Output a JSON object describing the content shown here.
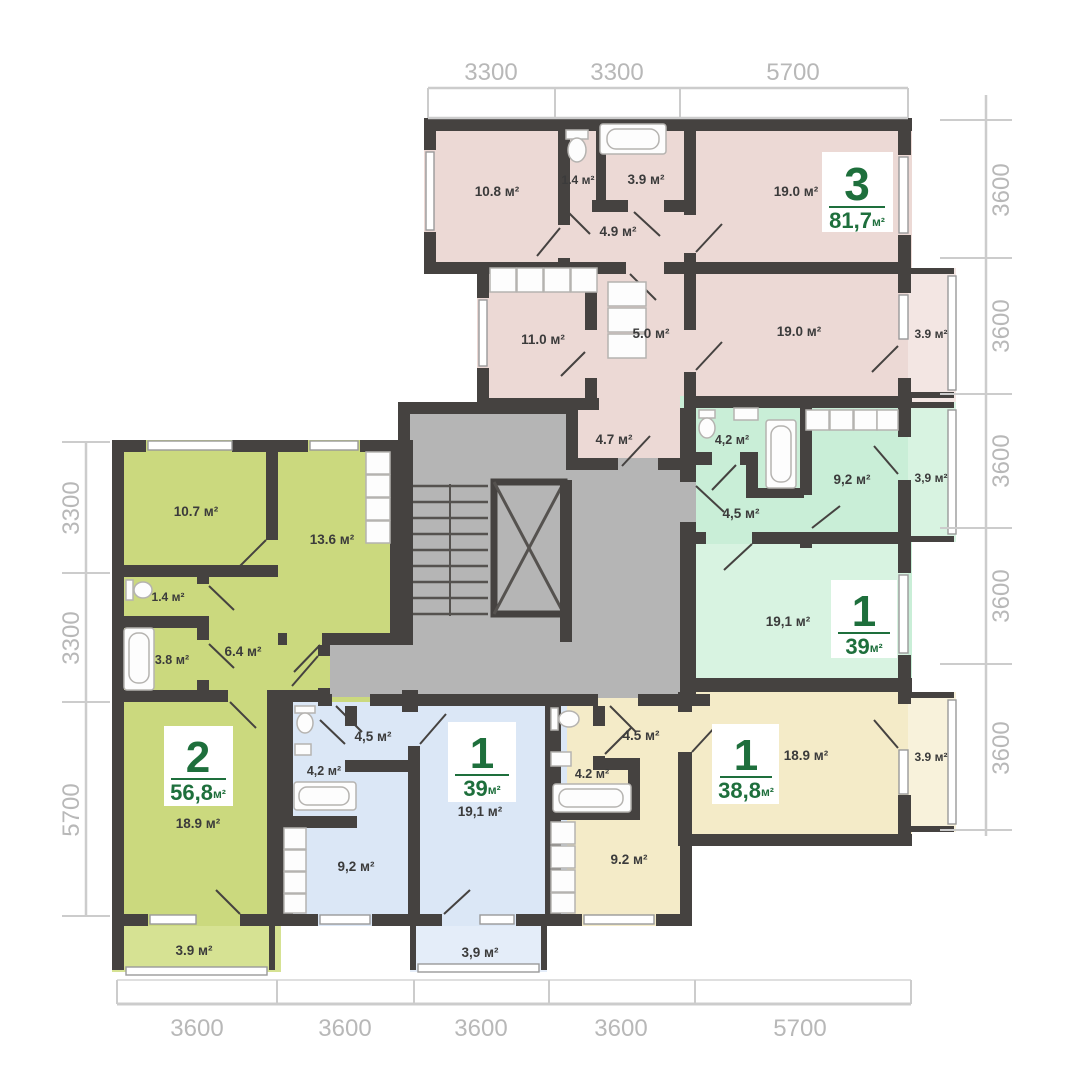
{
  "colors": {
    "wall": "#454240",
    "core": "#b5b5b5",
    "stair_line": "#55524f",
    "pink": "#ecd9d5",
    "pink_light": "#f3e6e3",
    "mint": "#c9eed7",
    "mint_light": "#d8f3e1",
    "yellow": "#f4ebc8",
    "yellow_light": "#f8f2db",
    "blue": "#dbe7f6",
    "blue_light": "#e4edf9",
    "lime": "#cbd97e",
    "lime_light": "#d6e293",
    "badge_bg": "#ffffff",
    "badge_green": "#1e6f3c",
    "label": "#3b3b3b",
    "dim_text": "#b8b8b8",
    "dim_line": "#cccccc",
    "fixture": "#b5b3b0",
    "fixture_fill": "#fdfdfd",
    "window": "#9a9a9a"
  },
  "dimensions": {
    "top": [
      "3300",
      "3300",
      "5700"
    ],
    "right": [
      "3600",
      "3600",
      "3600",
      "3600",
      "3600"
    ],
    "left": [
      "3300",
      "3300",
      "5700"
    ],
    "bottom": [
      "3600",
      "3600",
      "3600",
      "3600",
      "5700"
    ]
  },
  "apartments": [
    {
      "id": "apartment-3-rooms-pink",
      "type_number": "3",
      "total_area": "81,7",
      "unit": "м²",
      "rooms": [
        "10.8 м²",
        "1.4 м²",
        "3.9 м²",
        "4.9 м²",
        "19.0 м²",
        "11.0 м²",
        "5.0 м²",
        "19.0 м²",
        "3.9 м²",
        "4.7 м²"
      ]
    },
    {
      "id": "apartment-1-room-mint",
      "type_number": "1",
      "total_area": "39",
      "unit": "м²",
      "rooms": [
        "4,2 м²",
        "4,5 м²",
        "9,2 м²",
        "3,9 м²",
        "19,1 м²"
      ]
    },
    {
      "id": "apartment-1-room-yellow",
      "type_number": "1",
      "total_area": "38,8",
      "unit": "м²",
      "rooms": [
        "4.5 м²",
        "4.2 м²",
        "9.2 м²",
        "18.9 м²",
        "3.9 м²"
      ]
    },
    {
      "id": "apartment-1-room-blue",
      "type_number": "1",
      "total_area": "39",
      "unit": "м²",
      "rooms": [
        "4,5 м²",
        "4,2 м²",
        "9,2 м²",
        "19,1 м²",
        "3,9 м²"
      ]
    },
    {
      "id": "apartment-2-rooms-lime",
      "type_number": "2",
      "total_area": "56,8",
      "unit": "м²",
      "rooms": [
        "10.7 м²",
        "13.6 м²",
        "1.4 м²",
        "3.8 м²",
        "6.4 м²",
        "18.9 м²",
        "3.9 м²"
      ]
    }
  ]
}
